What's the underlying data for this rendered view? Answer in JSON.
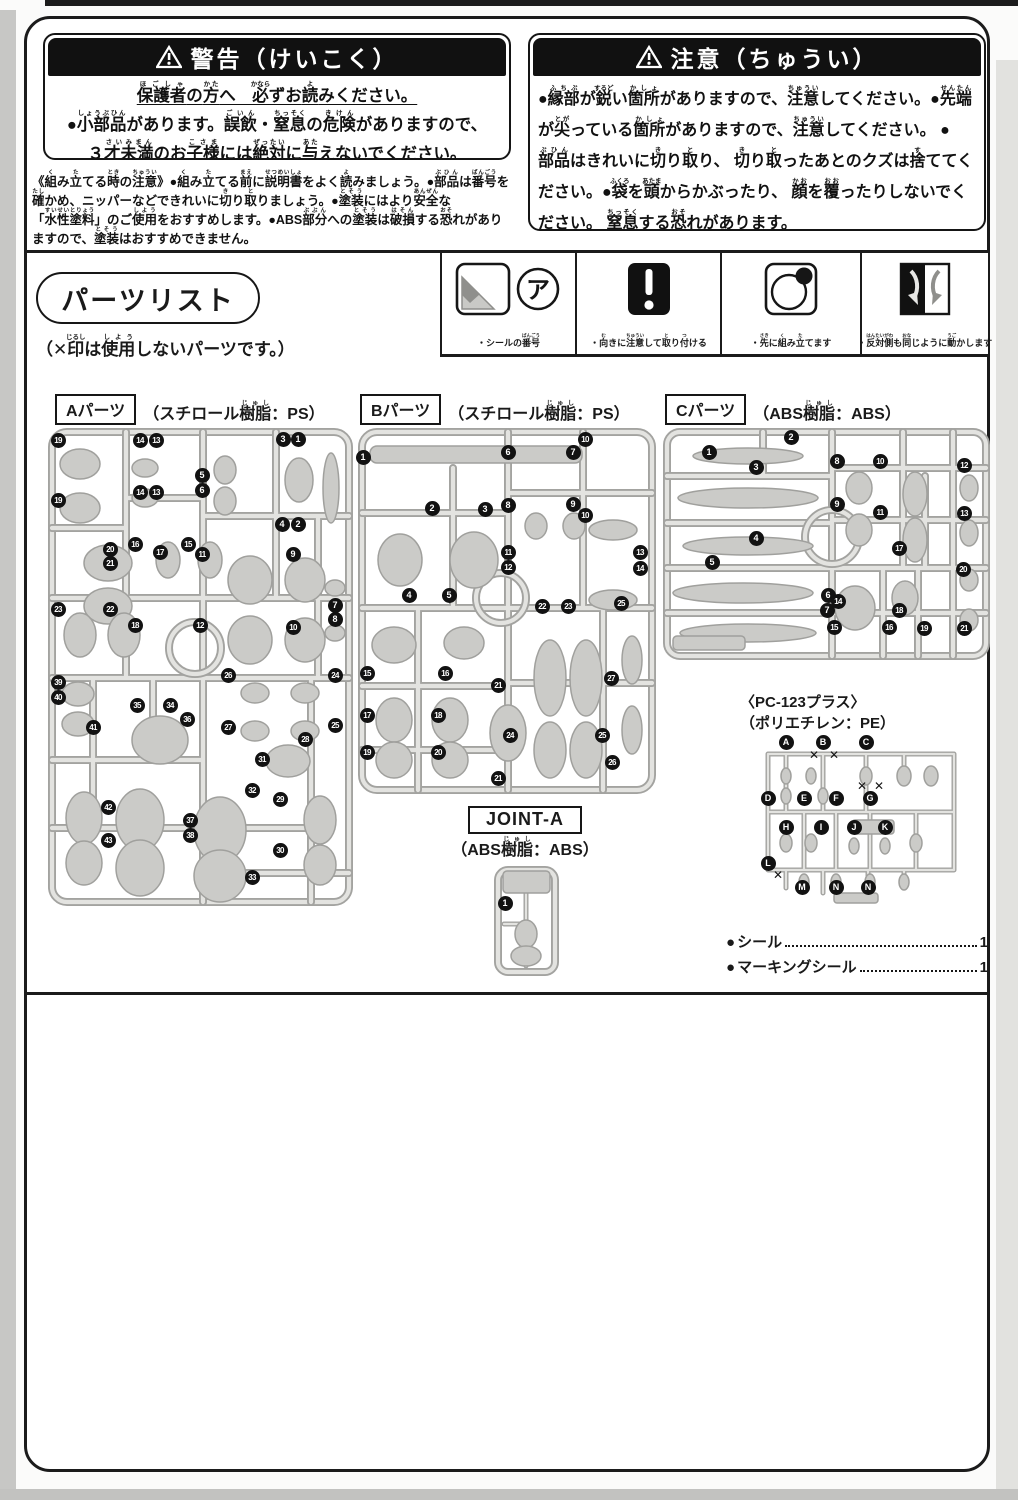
{
  "warning_box": {
    "title": "警告（けいこく）",
    "line1": [
      [
        "保護者",
        "ほごしゃ"
      ],
      "の",
      [
        "方",
        "かた"
      ],
      "へ　",
      [
        "必",
        "かなら"
      ],
      "ずお",
      [
        "読",
        "よ"
      ],
      "みください。"
    ],
    "line2": [
      "●",
      [
        "小部品",
        "しょうぶひん"
      ],
      "があります。",
      [
        "誤飲",
        "ごいん"
      ],
      "・",
      [
        "窒息",
        "ちっそく"
      ],
      "の",
      [
        "危険",
        "きけん"
      ],
      "がありますので、"
    ],
    "line3": [
      "３",
      [
        "才未満",
        "さいみまん"
      ],
      "のお",
      [
        "子様",
        "こさま"
      ],
      "には",
      [
        "絶対",
        "ぜったい"
      ],
      "に",
      [
        "与",
        "あた"
      ],
      "えないでください。"
    ]
  },
  "caution_box": {
    "title": "注意（ちゅうい）",
    "p1": [
      "●",
      [
        "縁部",
        "ふちぶ"
      ],
      "が",
      [
        "鋭",
        "するど"
      ],
      "い",
      [
        "箇所",
        "かしょ"
      ],
      "がありますので、",
      [
        "注意",
        "ちゅうい"
      ],
      "してください。●",
      [
        "先",
        "せん"
      ],
      [
        "端",
        "たん"
      ],
      "が",
      [
        "尖",
        "とが"
      ],
      "っている",
      [
        "箇所",
        "かしょ"
      ],
      "がありますので、",
      [
        "注意",
        "ちゅうい"
      ],
      "してください。"
    ],
    "p2": [
      "●",
      [
        "部品",
        "ぶひん"
      ],
      "はきれいに",
      [
        "切",
        "き"
      ],
      "り",
      [
        "取",
        "と"
      ],
      "り、 ",
      [
        "切",
        "き"
      ],
      "り",
      [
        "取",
        "と"
      ],
      "ったあとのクズは",
      [
        "捨",
        "す"
      ],
      "ててください。●",
      [
        "袋",
        "ふくろ"
      ],
      "を",
      [
        "頭",
        "あたま"
      ],
      "からかぶったり、 ",
      [
        "顔",
        "かお"
      ],
      "を",
      [
        "覆",
        "おお"
      ],
      "ったりしないでください。 ",
      [
        "窒息",
        "ちっそく"
      ],
      "する",
      [
        "恐",
        "おそ"
      ],
      "れがあります。"
    ]
  },
  "assembly_notes": [
    "《",
    [
      "組",
      "く"
    ],
    "み",
    [
      "立",
      "た"
    ],
    "てる",
    [
      "時",
      "とき"
    ],
    "の",
    [
      "注意",
      "ちゅうい"
    ],
    "》●",
    [
      "組",
      "く"
    ],
    "み",
    [
      "立",
      "た"
    ],
    "てる",
    [
      "前",
      "まえ"
    ],
    "に",
    [
      "説明書",
      "せつめいしょ"
    ],
    "をよく",
    [
      "読",
      "よ"
    ],
    "みましょう。●",
    [
      "部品",
      "ぶひん"
    ],
    "は",
    [
      "番号",
      "ばんごう"
    ],
    "を",
    [
      "確",
      "たし"
    ],
    "かめ、ニッパーなどできれいに",
    [
      "切",
      "き"
    ],
    "り",
    [
      "取",
      "と"
    ],
    "りましょう。●",
    [
      "塗装",
      "とそう"
    ],
    "にはより",
    [
      "安全",
      "あんぜん"
    ],
    "な「",
    [
      "水性塗料",
      "すいせいとりょう"
    ],
    "」のご",
    [
      "使用",
      "しよう"
    ],
    "をおすすめします。●ABS",
    [
      "部分",
      "ぶぶん"
    ],
    "への",
    [
      "塗装",
      "とそう"
    ],
    "は",
    [
      "破損",
      "はそん"
    ],
    "する",
    [
      "恐",
      "おそ"
    ],
    "れがありますので、",
    [
      "塗装",
      "とそう"
    ],
    "はおすすめできません。"
  ],
  "parts_list": {
    "title": "パーツリスト",
    "unused_note": [
      "（✕",
      [
        "印",
        "じるし"
      ],
      "は",
      [
        "使用",
        "しよう"
      ],
      "しないパーツです。）"
    ],
    "legend": [
      {
        "icon": "sticker-number-icon",
        "sticker_letter": "ア",
        "caption": [
          "・シールの",
          [
            "番号",
            "ばんごう"
          ]
        ]
      },
      {
        "icon": "orientation-warning-icon",
        "caption": [
          "・",
          [
            "向",
            "む"
          ],
          "きに",
          [
            "注意",
            "ちゅうい"
          ],
          "して",
          [
            "取",
            "と"
          ],
          "り",
          [
            "付",
            "つ"
          ],
          "ける"
        ]
      },
      {
        "icon": "assemble-first-icon",
        "caption": [
          "・",
          [
            "先",
            "さき"
          ],
          "に",
          [
            "組",
            "く"
          ],
          "み",
          [
            "立",
            "た"
          ],
          "てます"
        ]
      },
      {
        "icon": "mirror-motion-icon",
        "caption": [
          "・",
          [
            "反対側",
            "はんたいがわ"
          ],
          "も",
          [
            "同",
            "おな"
          ],
          "じように",
          [
            "動",
            "うご"
          ],
          "かします"
        ]
      }
    ],
    "runners": {
      "a": {
        "label": "Aパーツ",
        "material": [
          "（スチロール",
          [
            "樹脂",
            "じゅし"
          ],
          "：PS）"
        ],
        "markers": [
          [
            "19",
            10,
            12
          ],
          [
            "14",
            92,
            12
          ],
          [
            "13",
            108,
            12
          ],
          [
            "3",
            235,
            11
          ],
          [
            "1",
            250,
            11
          ],
          [
            "5",
            154,
            47
          ],
          [
            "6",
            154,
            62
          ],
          [
            "14",
            92,
            64
          ],
          [
            "13",
            108,
            64
          ],
          [
            "19",
            10,
            72
          ],
          [
            "4",
            234,
            96
          ],
          [
            "2",
            250,
            96
          ],
          [
            "16",
            87,
            116
          ],
          [
            "15",
            140,
            116
          ],
          [
            "20",
            62,
            121
          ],
          [
            "17",
            112,
            124
          ],
          [
            "11",
            154,
            126
          ],
          [
            "9",
            245,
            126
          ],
          [
            "21",
            62,
            135
          ],
          [
            "7",
            287,
            177
          ],
          [
            "8",
            287,
            191
          ],
          [
            "23",
            10,
            181
          ],
          [
            "22",
            62,
            181
          ],
          [
            "18",
            87,
            197
          ],
          [
            "12",
            152,
            197
          ],
          [
            "10",
            245,
            199
          ],
          [
            "39",
            10,
            254
          ],
          [
            "40",
            10,
            269
          ],
          [
            "26",
            180,
            247
          ],
          [
            "24",
            287,
            247
          ],
          [
            "35",
            89,
            277
          ],
          [
            "34",
            122,
            277
          ],
          [
            "36",
            139,
            291
          ],
          [
            "41",
            45,
            299
          ],
          [
            "27",
            180,
            299
          ],
          [
            "25",
            287,
            297
          ],
          [
            "28",
            257,
            311
          ],
          [
            "31",
            214,
            331
          ],
          [
            "32",
            204,
            362
          ],
          [
            "29",
            232,
            371
          ],
          [
            "42",
            60,
            379
          ],
          [
            "37",
            142,
            392
          ],
          [
            "38",
            142,
            407
          ],
          [
            "43",
            60,
            412
          ],
          [
            "30",
            232,
            422
          ],
          [
            "33",
            204,
            449
          ]
        ]
      },
      "b": {
        "label": "Bパーツ",
        "material": [
          "（スチロール",
          [
            "樹脂",
            "じゅし"
          ],
          "：PS）"
        ],
        "markers": [
          [
            "1",
            5,
            29
          ],
          [
            "6",
            150,
            24
          ],
          [
            "7",
            215,
            24
          ],
          [
            "10",
            227,
            11
          ],
          [
            "2",
            74,
            80
          ],
          [
            "3",
            127,
            81
          ],
          [
            "8",
            150,
            77
          ],
          [
            "9",
            215,
            76
          ],
          [
            "10",
            227,
            87
          ],
          [
            "11",
            150,
            124
          ],
          [
            "12",
            150,
            139
          ],
          [
            "13",
            282,
            124
          ],
          [
            "14",
            282,
            140
          ],
          [
            "4",
            51,
            167
          ],
          [
            "5",
            91,
            167
          ],
          [
            "22",
            184,
            178
          ],
          [
            "23",
            210,
            178
          ],
          [
            "25",
            263,
            175
          ],
          [
            "15",
            9,
            245
          ],
          [
            "16",
            87,
            245
          ],
          [
            "21",
            140,
            257
          ],
          [
            "27",
            253,
            250
          ],
          [
            "17",
            9,
            287
          ],
          [
            "18",
            80,
            287
          ],
          [
            "24",
            152,
            307
          ],
          [
            "25",
            244,
            307
          ],
          [
            "19",
            9,
            324
          ],
          [
            "20",
            80,
            324
          ],
          [
            "26",
            254,
            334
          ],
          [
            "21",
            140,
            350
          ]
        ]
      },
      "c": {
        "label": "Cパーツ",
        "material": [
          "（ABS",
          [
            "樹脂",
            "じゅし"
          ],
          "：ABS）"
        ],
        "markers": [
          [
            "1",
            46,
            24
          ],
          [
            "2",
            128,
            9
          ],
          [
            "3",
            93,
            39
          ],
          [
            "8",
            174,
            33
          ],
          [
            "10",
            217,
            33
          ],
          [
            "12",
            301,
            37
          ],
          [
            "9",
            174,
            76
          ],
          [
            "11",
            217,
            84
          ],
          [
            "13",
            301,
            85
          ],
          [
            "4",
            93,
            110
          ],
          [
            "5",
            49,
            134
          ],
          [
            "17",
            236,
            120
          ],
          [
            "20",
            300,
            141
          ],
          [
            "6",
            165,
            167
          ],
          [
            "14",
            175,
            173
          ],
          [
            "7",
            164,
            182
          ],
          [
            "18",
            236,
            182
          ],
          [
            "15",
            171,
            199
          ],
          [
            "16",
            226,
            199
          ],
          [
            "19",
            261,
            200
          ],
          [
            "21",
            301,
            200
          ]
        ]
      }
    },
    "pc": {
      "label_line1": "〈PC-123プラス〉",
      "label_line2": "（ポリエチレン：PE）",
      "markers": [
        [
          "A",
          30,
          4
        ],
        [
          "B",
          67,
          4
        ],
        [
          "C",
          110,
          4
        ],
        [
          "D",
          12,
          60
        ],
        [
          "E",
          48,
          60
        ],
        [
          "F",
          80,
          60
        ],
        [
          "G",
          114,
          60
        ],
        [
          "H",
          30,
          89
        ],
        [
          "I",
          65,
          89
        ],
        [
          "J",
          98,
          89
        ],
        [
          "K",
          129,
          89
        ],
        [
          "L",
          12,
          125
        ],
        [
          "M",
          46,
          149
        ],
        [
          "N",
          80,
          149
        ],
        [
          "N",
          112,
          149
        ]
      ],
      "xmarks": [
        [
          59,
          17
        ],
        [
          79,
          17
        ],
        [
          107,
          48
        ],
        [
          124,
          48
        ],
        [
          23,
          137
        ]
      ]
    },
    "joint": {
      "label": "JOINT-A",
      "material": [
        "（ABS",
        [
          "樹脂",
          "じゅし"
        ],
        "：ABS）"
      ],
      "markers": [
        [
          "1",
          11,
          37
        ]
      ]
    },
    "accessories": [
      {
        "label": "シール",
        "qty": "1"
      },
      {
        "label": "マーキングシール",
        "qty": "1"
      }
    ]
  }
}
